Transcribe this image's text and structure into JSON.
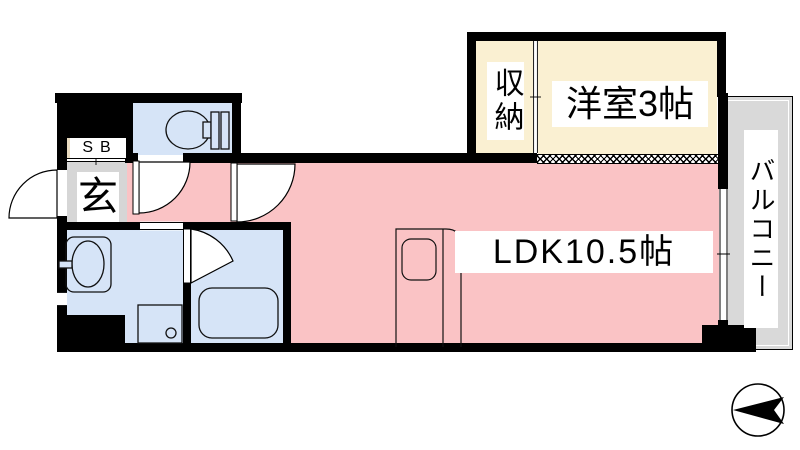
{
  "rooms": {
    "ldk": {
      "label": "LDK10.5帖",
      "color": "#fac3c5"
    },
    "western_room": {
      "label": "洋室3帖",
      "color": "#faf0d2"
    },
    "closet": {
      "label": "収納",
      "color": "#faf0d2"
    },
    "balcony": {
      "label": "バルコニー",
      "color": "#d9d9d9"
    },
    "entrance": {
      "label": "玄",
      "color": "#d6d6d6"
    },
    "shoe_box": {
      "label": "SB",
      "color": "#e9dcc1"
    },
    "toilet": {
      "color": "#d6e4f7"
    },
    "washroom": {
      "color": "#d6e4f7"
    },
    "bathroom": {
      "color": "#d6e4f7"
    }
  },
  "structure": {
    "wall_color": "#000000",
    "outside_color": "#ffffff",
    "window_symbols": [
      "balcony-sliding-window",
      "washroom-window",
      "closet-sliding-door",
      "shoebox-sliding-door"
    ]
  },
  "fixtures": {
    "list": [
      "toilet",
      "washbasin",
      "washing-machine-pan",
      "bathtub",
      "kitchen-sink-counter"
    ]
  },
  "compass": {
    "type": "north-arrow",
    "direction": "left"
  }
}
